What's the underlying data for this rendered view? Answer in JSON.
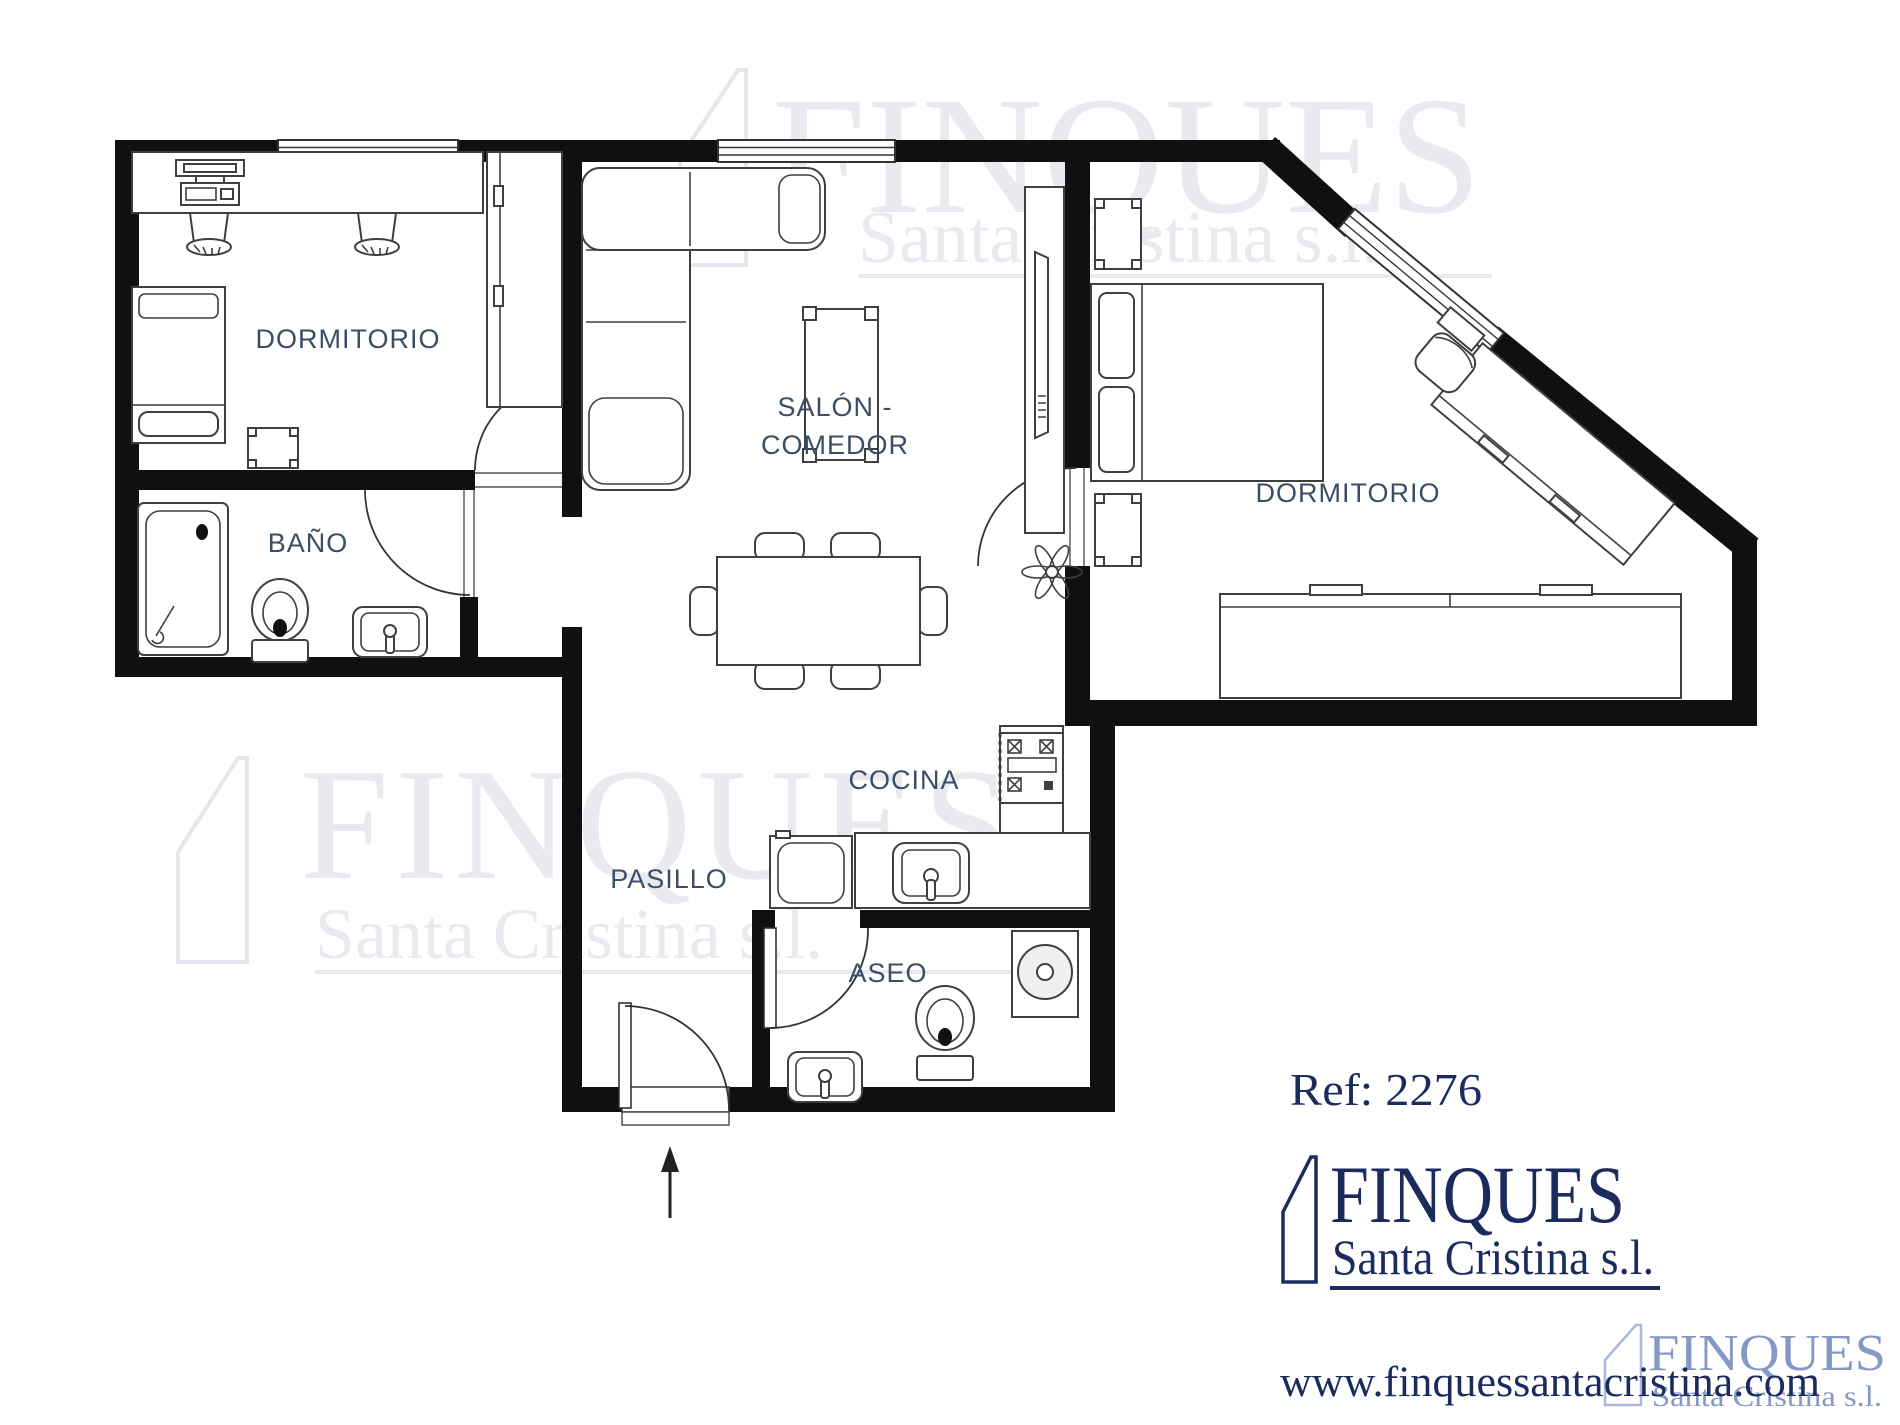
{
  "colors": {
    "background": "#ffffff",
    "wall": "#101010",
    "furniture_stroke": "#3f3f3f",
    "room_label": "#3c4d66",
    "brand_navy": "#1c2b5e",
    "watermark_gray": "#e8eaef",
    "watermark_blue": "#8599c5"
  },
  "rooms": [
    {
      "id": "dormitorio-left",
      "label": "DORMITORIO"
    },
    {
      "id": "bano",
      "label": "BAÑO"
    },
    {
      "id": "salon-comedor",
      "label_line1": "SALÓN -",
      "label_line2": "COMEDOR"
    },
    {
      "id": "dormitorio-right",
      "label": "DORMITORIO"
    },
    {
      "id": "cocina",
      "label": "COCINA"
    },
    {
      "id": "pasillo",
      "label": "PASILLO"
    },
    {
      "id": "aseo",
      "label": "ASEO"
    }
  ],
  "branding": {
    "reference": "Ref: 2276",
    "company": "FINQUES",
    "company_subtitle": "Santa Cristina s.l.",
    "website": "www.finquessantacristina.com"
  },
  "watermarks": {
    "top": {
      "line1": "FINQUES",
      "line2": "Santa Cristina s.l."
    },
    "middle_left": {
      "line1": "FINQUES",
      "line2": "Santa Cristina s.l."
    },
    "bottom_right": {
      "line1": "FINQUES",
      "line2": "Santa Cristina s.l."
    }
  }
}
